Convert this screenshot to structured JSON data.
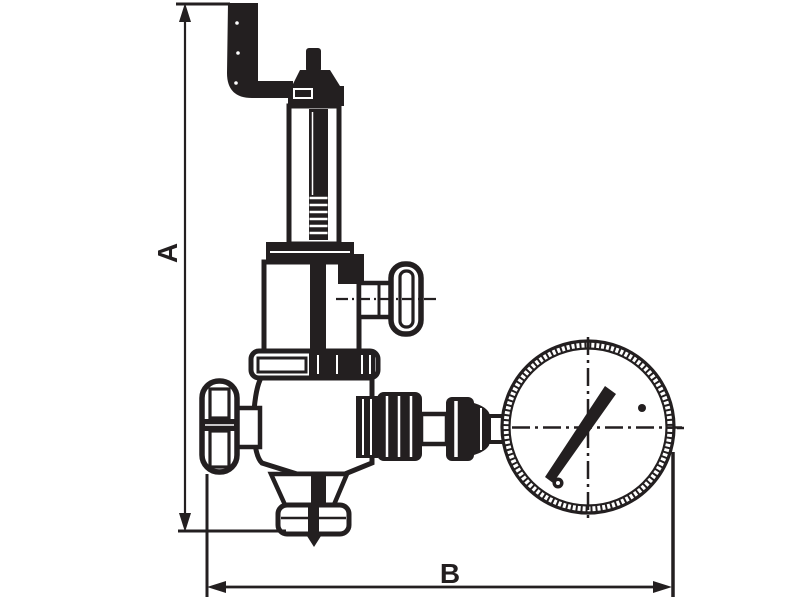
{
  "drawing": {
    "type": "technical-dimension-drawing",
    "background_color": "#ffffff",
    "ink_color": "#231f20",
    "dimension_labels": {
      "vertical": "A",
      "horizontal": "B"
    },
    "parts": [
      "outlet-elbow-pipe",
      "adjusting-screw-cap",
      "spring-bonnet",
      "spring-chamber",
      "side-tee-handle",
      "union-nut-collar",
      "valve-body",
      "handwheel",
      "bottom-flange",
      "gauge-connection-fittings",
      "pressure-gauge"
    ]
  }
}
